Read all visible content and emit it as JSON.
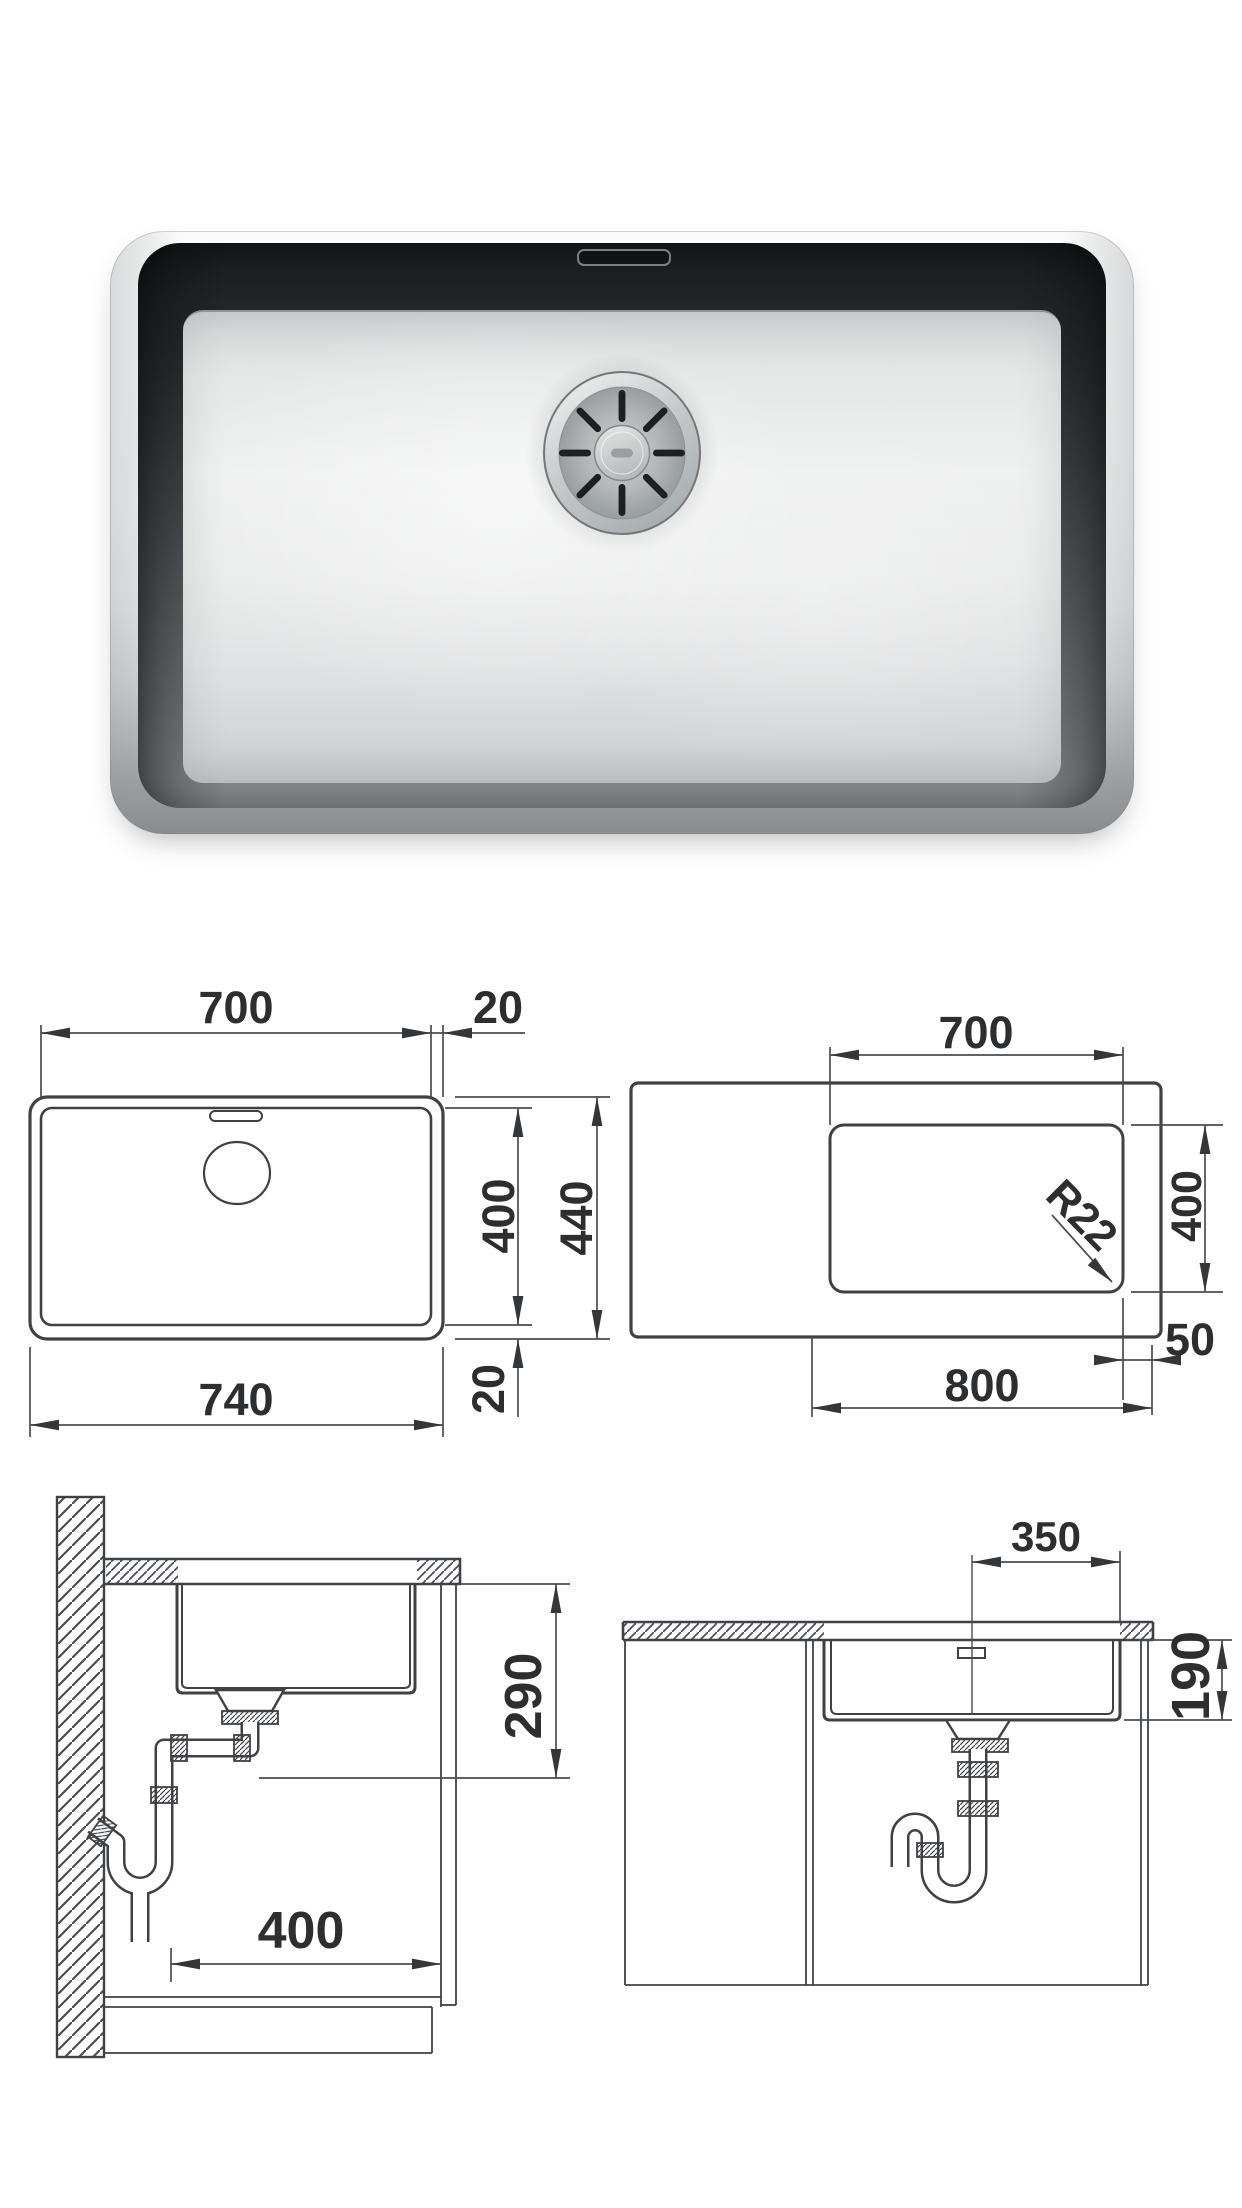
{
  "page": {
    "background": "#ffffff"
  },
  "photo": {
    "description": "stainless steel undermount sink bowl, top view",
    "steel_light": "#eff0f0",
    "steel_dark": "#17191b",
    "rim_color": "#f6f7f7"
  },
  "drawings": {
    "line_color": "#3f4245",
    "top_view": {
      "width_inner": "700",
      "rim_right": "20",
      "depth_inner": "400",
      "depth_outer": "440",
      "width_outer": "740",
      "rim_bottom": "20"
    },
    "cutout": {
      "width": "700",
      "depth": "400",
      "radius": "R22",
      "offset": "50",
      "span": "800"
    },
    "side_section": {
      "height": "290",
      "width": "400"
    },
    "front_section": {
      "offset": "350",
      "depth": "190"
    }
  }
}
